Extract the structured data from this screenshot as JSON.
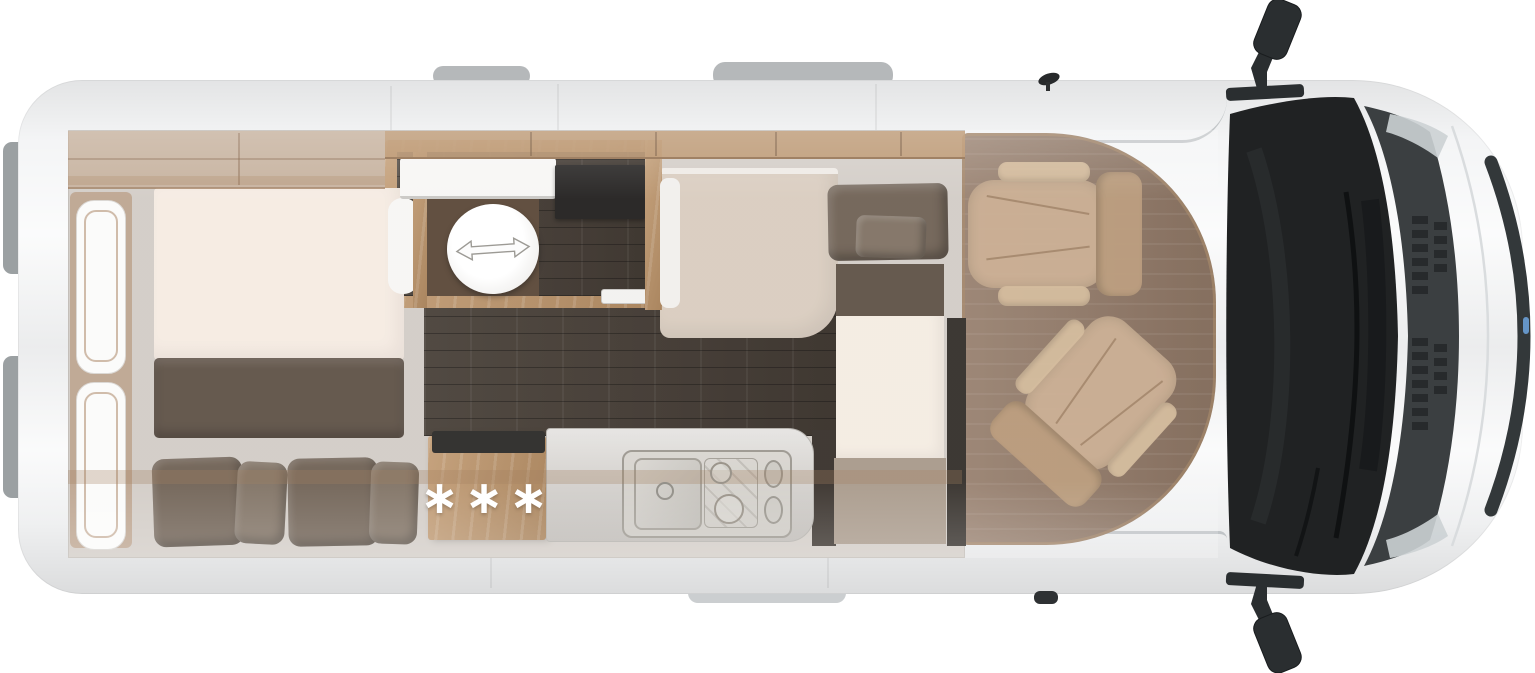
{
  "floorplan": {
    "kitchen": {
      "marker": "∗∗∗"
    },
    "icons": {
      "toilet_slide_arrow": "left-right-arrow",
      "kitchen_marker": "three-asterisks",
      "side_mirror": "side-mirror",
      "antenna": "roof-antenna"
    },
    "colors": {
      "body": "#f4f5f6",
      "roof_tab": "#b5b8ba",
      "bumper_gray": "#9ba0a2",
      "step_gray": "#cbced0",
      "interior_base": "#d2ccc6",
      "wood": "#b98e61",
      "wood_dark": "#8a6a4a",
      "floor_dark": "#3d342c",
      "cab_floor": "#8d7360",
      "mattress": "#f5ebe2",
      "blanket": "#5e5146",
      "pillow": "#6f6154",
      "pillow_light": "#7f7163",
      "cushion": "#f4ece2",
      "bench_beige": "#d9ccbf",
      "bench_base": "#a8998a",
      "counter": "#cdc9c4",
      "steel": "#9b978f",
      "windshield": "#202223",
      "hood": "#3b3f41",
      "trim": "#33383a",
      "mirror": "#2a2e30",
      "panel_white": "#f7f6f4",
      "toilet": "#ffffff",
      "marker": "#ffffff",
      "slot_dark": "#2a2927",
      "band_dark": "#332e29",
      "accent_blue": "#6ea6e0"
    }
  }
}
